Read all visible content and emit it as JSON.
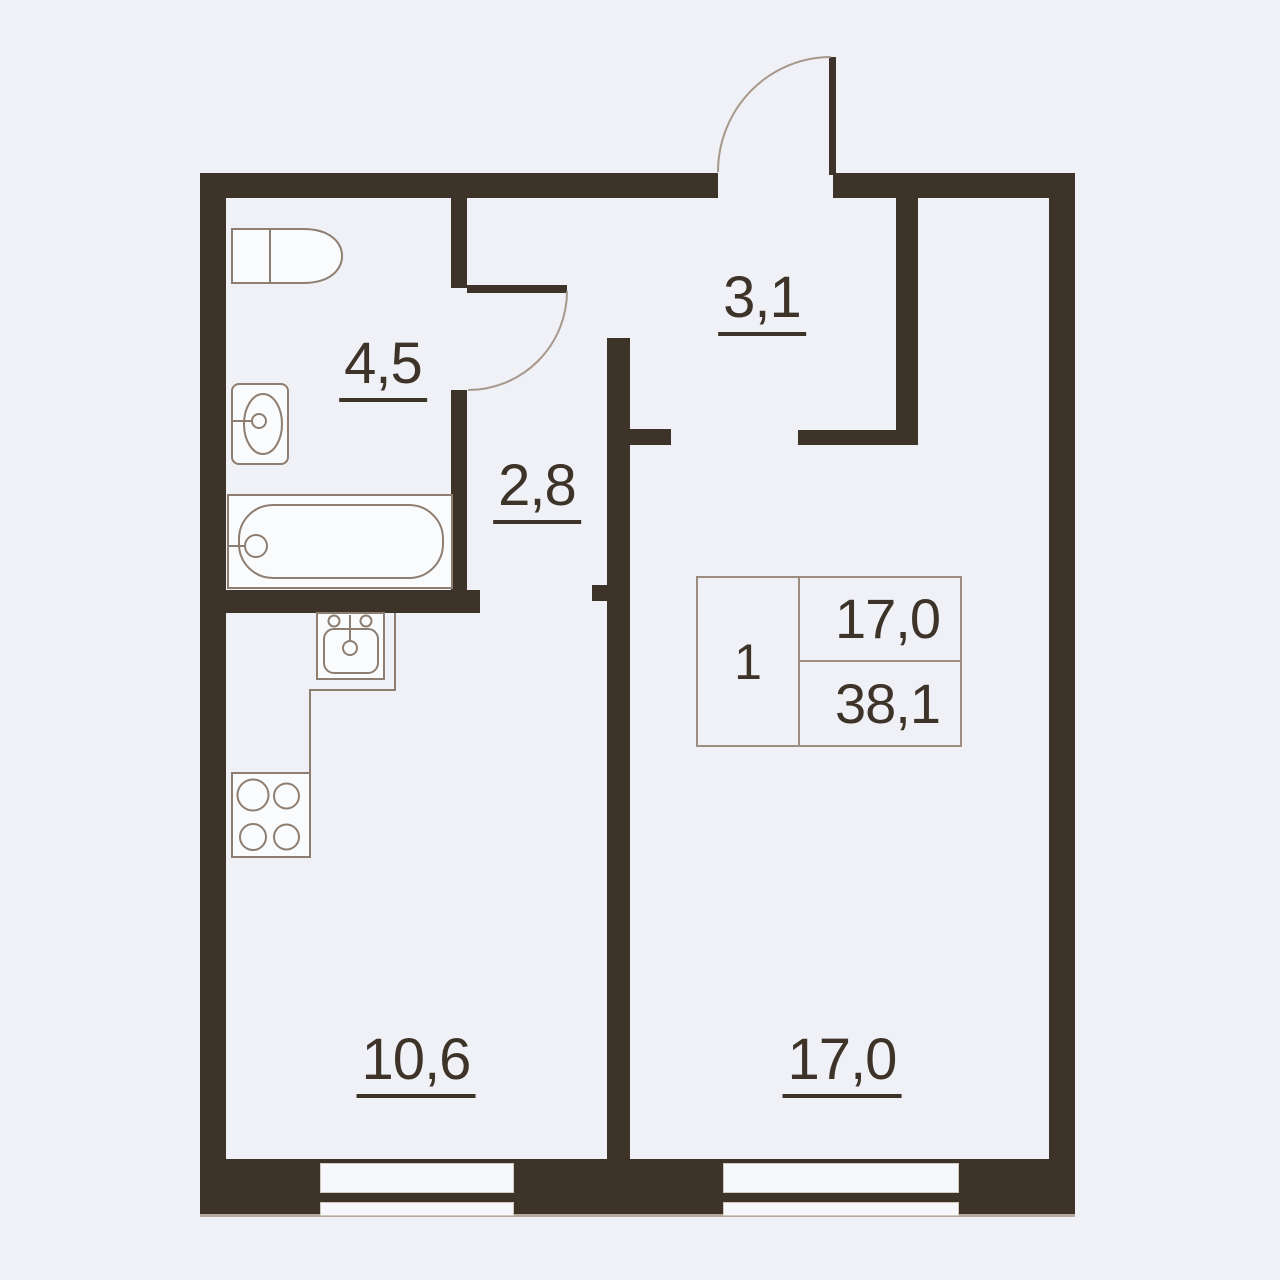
{
  "plan": {
    "rooms": {
      "bathroom": {
        "label": "4,5"
      },
      "hallway": {
        "label": "3,1"
      },
      "corridor": {
        "label": "2,8"
      },
      "kitchen": {
        "label": "10,6"
      },
      "living_room": {
        "label": "17,0"
      }
    },
    "info_table": {
      "rooms_count": "1",
      "living_area": "17,0",
      "total_area": "38,1"
    },
    "fixtures": [
      "toilet-icon",
      "bathroom-sink-icon",
      "bathtub-icon",
      "kitchen-sink-icon",
      "stove-icon",
      "entrance-door-icon",
      "bathroom-door-icon",
      "window-icon"
    ],
    "colors": {
      "wall": "#3e3329",
      "background": "#eff1f6",
      "text": "#3e3329",
      "fixture_line": "#8d7e71",
      "fixture_fill": "#fafbfd",
      "arc_line": "#a6988b",
      "table_border": "#9b8d80",
      "window_pane": "#f6f8fb"
    }
  }
}
